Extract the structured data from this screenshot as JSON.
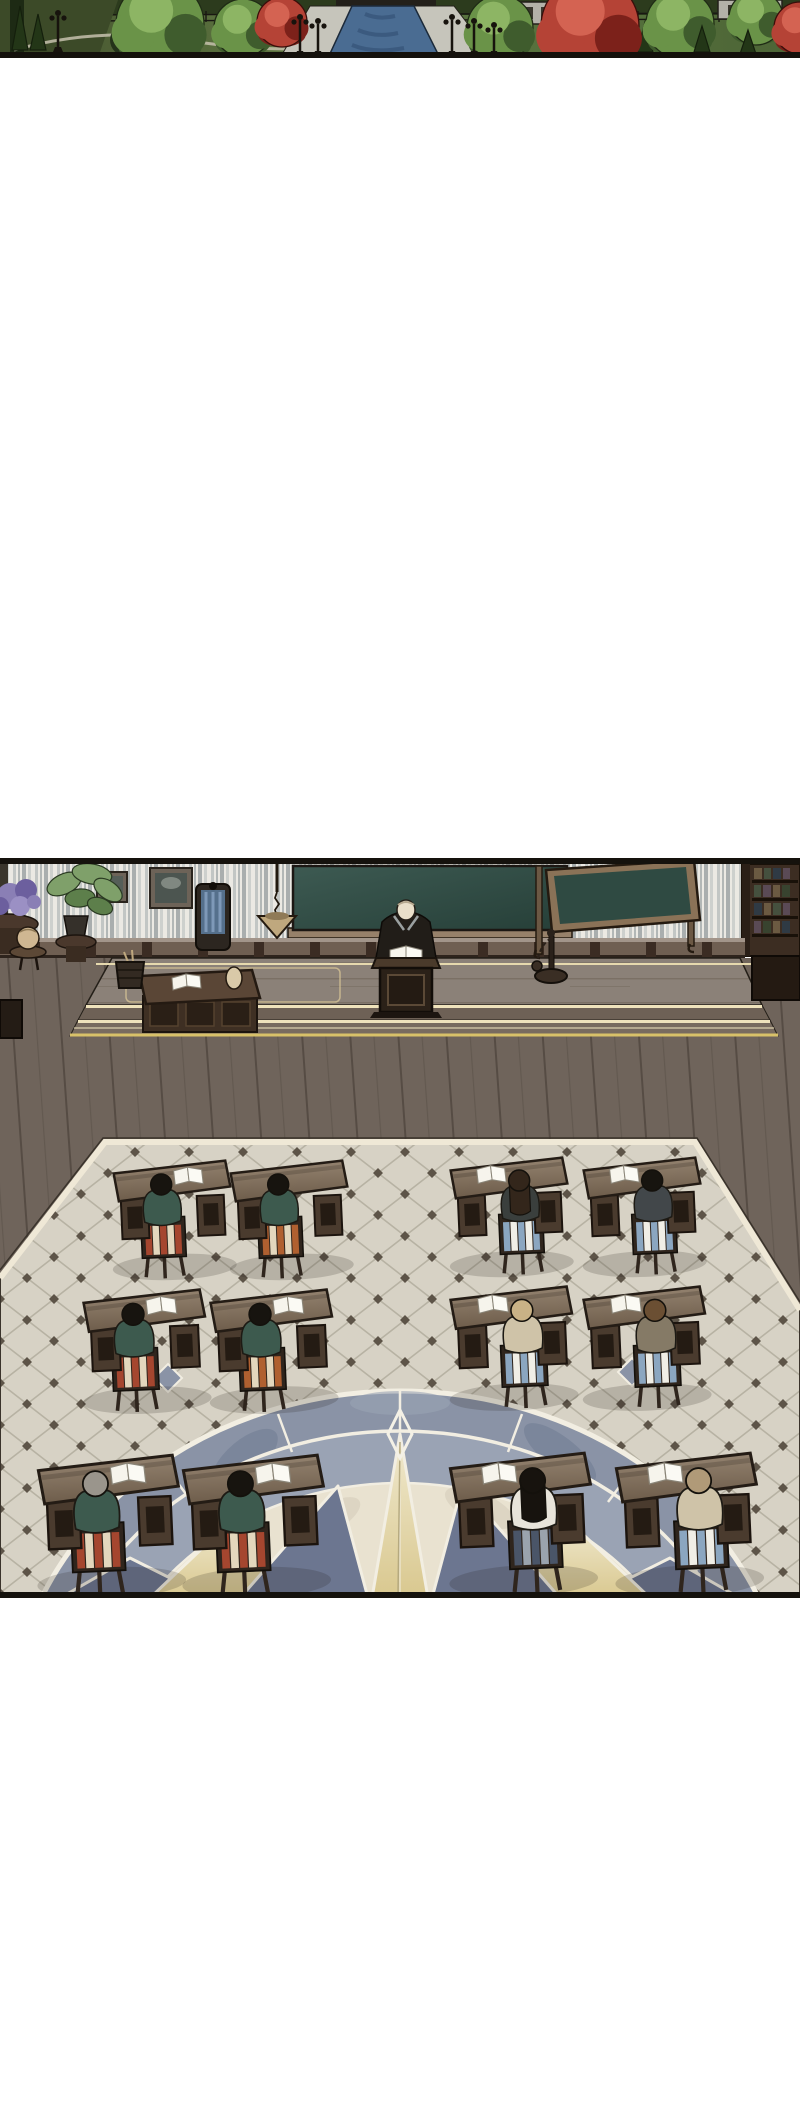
{
  "meta": {
    "kind": "wordless comic page (webtoon)",
    "page_width": 800,
    "page_height": 2118,
    "visible_text": "none"
  },
  "palette": {
    "pageBg": "#ffffff",
    "inkBorder": "#15120d",
    "lawn": "#5d7440",
    "lawnDark": "#3c4a28",
    "hedge": "#2c3b1d",
    "water": "#4a6c92",
    "waterDark": "#37567a",
    "stonePath": "#c6c5bb",
    "wallWhite": "#ebe9e3",
    "curtainStripe": "#a9aeae",
    "blackboardGreen": "#2f4a42",
    "boardFrame": "#97816a",
    "wainscot": "#6f5f52",
    "stageTop": "#8b8178",
    "creamTrim": "#eadfb6",
    "goldTrim": "#d8c169",
    "woodFloor": "#6f645b",
    "woodLine": "#564c44",
    "tile": "#d7d2c5",
    "tileLine": "#b7b2a3",
    "tileDot": "#5d5448",
    "tileBorder": "#efe8d6",
    "compassRing": "#8a93a6",
    "compassNavy": "#6c7690",
    "marble": "#e9e2d0",
    "deskTopLight": "#93826f",
    "deskTopDark": "#6e5d4b",
    "deskWood": "#4a3b2e",
    "chairWood": "#2f251d",
    "bookWhite": "#f6f4ec",
    "teacherRobe": "#211d18",
    "skin": "#e9dfca"
  },
  "panels": {
    "garden_strip": {
      "y": 0,
      "height": 58,
      "description": "top-down palace garden: lawns, green trees, red maples, cypress topiary, iron lamp posts, stone walkways flanking a blue water canal"
    },
    "classroom": {
      "y": 858,
      "height": 740,
      "description": "top-down lecture hall: teacher at a podium on a raised platform before a blackboard; twelve student desks in three rows on a tiled floor with a giant compass-rose marble inlay"
    }
  },
  "garden": {
    "items": [
      {
        "type": "cypress",
        "x": 20,
        "top": 6,
        "h": 44
      },
      {
        "type": "cypress",
        "x": 38,
        "top": 14,
        "h": 36
      },
      {
        "type": "bush",
        "x": 126,
        "y": 40,
        "r": 16
      },
      {
        "type": "lamp",
        "x": 58,
        "top": 10,
        "h": 42
      },
      {
        "type": "canopy",
        "x": 160,
        "y": 24,
        "r": 44,
        "shade": "green"
      },
      {
        "type": "canopy",
        "x": 243,
        "y": 28,
        "r": 29,
        "shade": "green"
      },
      {
        "type": "red",
        "x": 282,
        "y": 22,
        "r": 25
      },
      {
        "type": "canopy",
        "x": 500,
        "y": 28,
        "r": 33,
        "shade": "green"
      },
      {
        "type": "cypress",
        "x": 645,
        "top": 22,
        "h": 30
      },
      {
        "type": "canopy",
        "x": 680,
        "y": 24,
        "r": 34,
        "shade": "green"
      },
      {
        "type": "cypress",
        "x": 702,
        "top": 26,
        "h": 26
      },
      {
        "type": "canopy",
        "x": 756,
        "y": 18,
        "r": 27,
        "shade": "green"
      },
      {
        "type": "cypress",
        "x": 748,
        "top": 30,
        "h": 24
      },
      {
        "type": "red",
        "x": 590,
        "y": 26,
        "r": 49
      },
      {
        "type": "red",
        "x": 800,
        "y": 28,
        "r": 26
      },
      {
        "type": "lamp",
        "x": 300,
        "top": 14,
        "h": 42
      },
      {
        "type": "lamp",
        "x": 318,
        "top": 18,
        "h": 38
      },
      {
        "type": "lamp",
        "x": 452,
        "top": 14,
        "h": 42
      },
      {
        "type": "lamp",
        "x": 474,
        "top": 18,
        "h": 38
      },
      {
        "type": "lamp",
        "x": 494,
        "top": 22,
        "h": 34
      }
    ]
  },
  "classroom": {
    "teacher": {
      "pose": "standing behind podium, head bowed over open book",
      "robe": "#211d18",
      "head": "#e9dfca"
    },
    "stage_objects": [
      "hydrangea-stand",
      "globe-stand",
      "potted-plant",
      "painting",
      "blackboard",
      "hanging-balance",
      "teacher-desk",
      "tall-chair",
      "waste-basket",
      "podium",
      "chain-stand",
      "easel-board",
      "bookshelf",
      "side-cabinet"
    ],
    "desks": [
      {
        "row": 1,
        "x": 115,
        "y": 305,
        "scale": 1.0,
        "flip": false,
        "jacket": "#3d5a4e",
        "hair": "#17140f",
        "hair_style": "short",
        "chair": [
          "#a5462f",
          "#e3d7bd"
        ],
        "book": true
      },
      {
        "row": 1,
        "x": 232,
        "y": 305,
        "scale": 1.0,
        "flip": false,
        "jacket": "#3d5a4e",
        "hair": "#17140f",
        "hair_style": "short",
        "chair": [
          "#b06030",
          "#e3d7bd"
        ],
        "book": false
      },
      {
        "row": 1,
        "x": 452,
        "y": 302,
        "scale": 1.0,
        "flip": true,
        "jacket": "#3a3f3d",
        "hair": "#33261b",
        "hair_style": "long",
        "chair": [
          "#8ba6c0",
          "#f0eee6"
        ],
        "book": true
      },
      {
        "row": 1,
        "x": 585,
        "y": 302,
        "scale": 1.0,
        "flip": true,
        "jacket": "#42474a",
        "hair": "#17140f",
        "hair_style": "short",
        "chair": [
          "#8ba6c0",
          "#f0eee6"
        ],
        "book": true
      },
      {
        "row": 2,
        "x": 85,
        "y": 434,
        "scale": 1.04,
        "flip": false,
        "jacket": "#3d5a4e",
        "hair": "#17140f",
        "hair_style": "short",
        "chair": [
          "#a5462f",
          "#e3d7bd"
        ],
        "book": true
      },
      {
        "row": 2,
        "x": 212,
        "y": 434,
        "scale": 1.04,
        "flip": false,
        "jacket": "#3d5a4e",
        "hair": "#17140f",
        "hair_style": "short",
        "chair": [
          "#b06030",
          "#e3d7bd"
        ],
        "book": true
      },
      {
        "row": 2,
        "x": 452,
        "y": 431,
        "scale": 1.04,
        "flip": true,
        "jacket": "#cfc3a8",
        "hair": "#c9b286",
        "hair_style": "short",
        "chair": [
          "#8ba6c0",
          "#f0eee6"
        ],
        "book": true
      },
      {
        "row": 2,
        "x": 585,
        "y": 431,
        "scale": 1.04,
        "flip": true,
        "jacket": "#857a66",
        "hair": "#6b4f33",
        "hair_style": "short",
        "chair": [
          "#8ba6c0",
          "#f0eee6"
        ],
        "book": true
      },
      {
        "row": 3,
        "x": 40,
        "y": 600,
        "scale": 1.2,
        "flip": false,
        "jacket": "#3d5a4e",
        "hair": "#9a958c",
        "hair_style": "short",
        "chair": [
          "#a5462f",
          "#e3d7bd"
        ],
        "book": true
      },
      {
        "row": 3,
        "x": 185,
        "y": 600,
        "scale": 1.2,
        "flip": false,
        "jacket": "#3d5a4e",
        "hair": "#17140f",
        "hair_style": "short",
        "chair": [
          "#a5462f",
          "#e3d7bd"
        ],
        "book": true
      },
      {
        "row": 3,
        "x": 452,
        "y": 598,
        "scale": 1.2,
        "flip": true,
        "jacket": "#e8e4da",
        "hair": "#17130e",
        "hair_style": "long",
        "chair": [
          "#4a5568",
          "#9aa3ad"
        ],
        "book": true
      },
      {
        "row": 3,
        "x": 618,
        "y": 598,
        "scale": 1.2,
        "flip": true,
        "jacket": "#cfc3a8",
        "hair": "#b09a78",
        "hair_style": "short",
        "chair": [
          "#8ba6c0",
          "#f0eee6"
        ],
        "book": true
      }
    ]
  }
}
